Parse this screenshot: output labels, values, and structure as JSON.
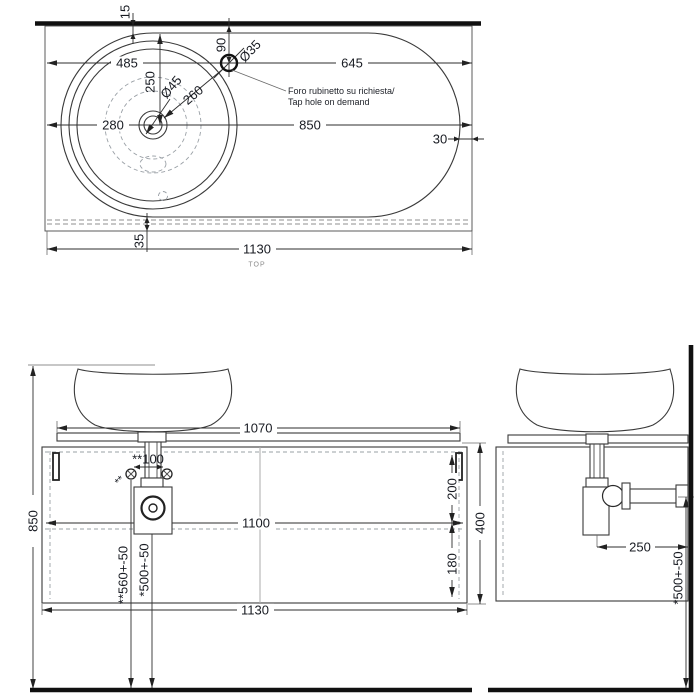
{
  "top_view": {
    "view_label": "TOP",
    "tap_note_line1": "Foro rubinetto su richiesta/",
    "tap_note_line2": "Tap hole on demand",
    "dim_wall_gap": "15",
    "dim_left_to_tap": "485",
    "dim_front_to_center": "250",
    "dim_wall_to_tap": "90",
    "dim_tap_diameter": "Ø35",
    "dim_tap_to_right": "645",
    "dim_drain_diameter": "Ø45",
    "dim_drain_to_tap": "260",
    "dim_left_to_center": "280",
    "dim_center_to_right": "850",
    "dim_right_gap": "30",
    "dim_bottom_gap": "35",
    "dim_total_width": "1130"
  },
  "front_view": {
    "dim_counter_width": "1070",
    "dim_screw_spacing": "**100",
    "screw_marker": "**",
    "dim_upper_offset": "200",
    "dim_inner_width": "1100",
    "dim_lower_offset": "180",
    "dim_panel_height": "400",
    "dim_total_height": "850",
    "dim_screw_height": "**560+-50",
    "dim_drain_height": "*500+-50",
    "dim_total_width": "1130"
  },
  "side_view": {
    "dim_drain_to_wall": "250",
    "dim_drain_height": "*500+-50"
  }
}
